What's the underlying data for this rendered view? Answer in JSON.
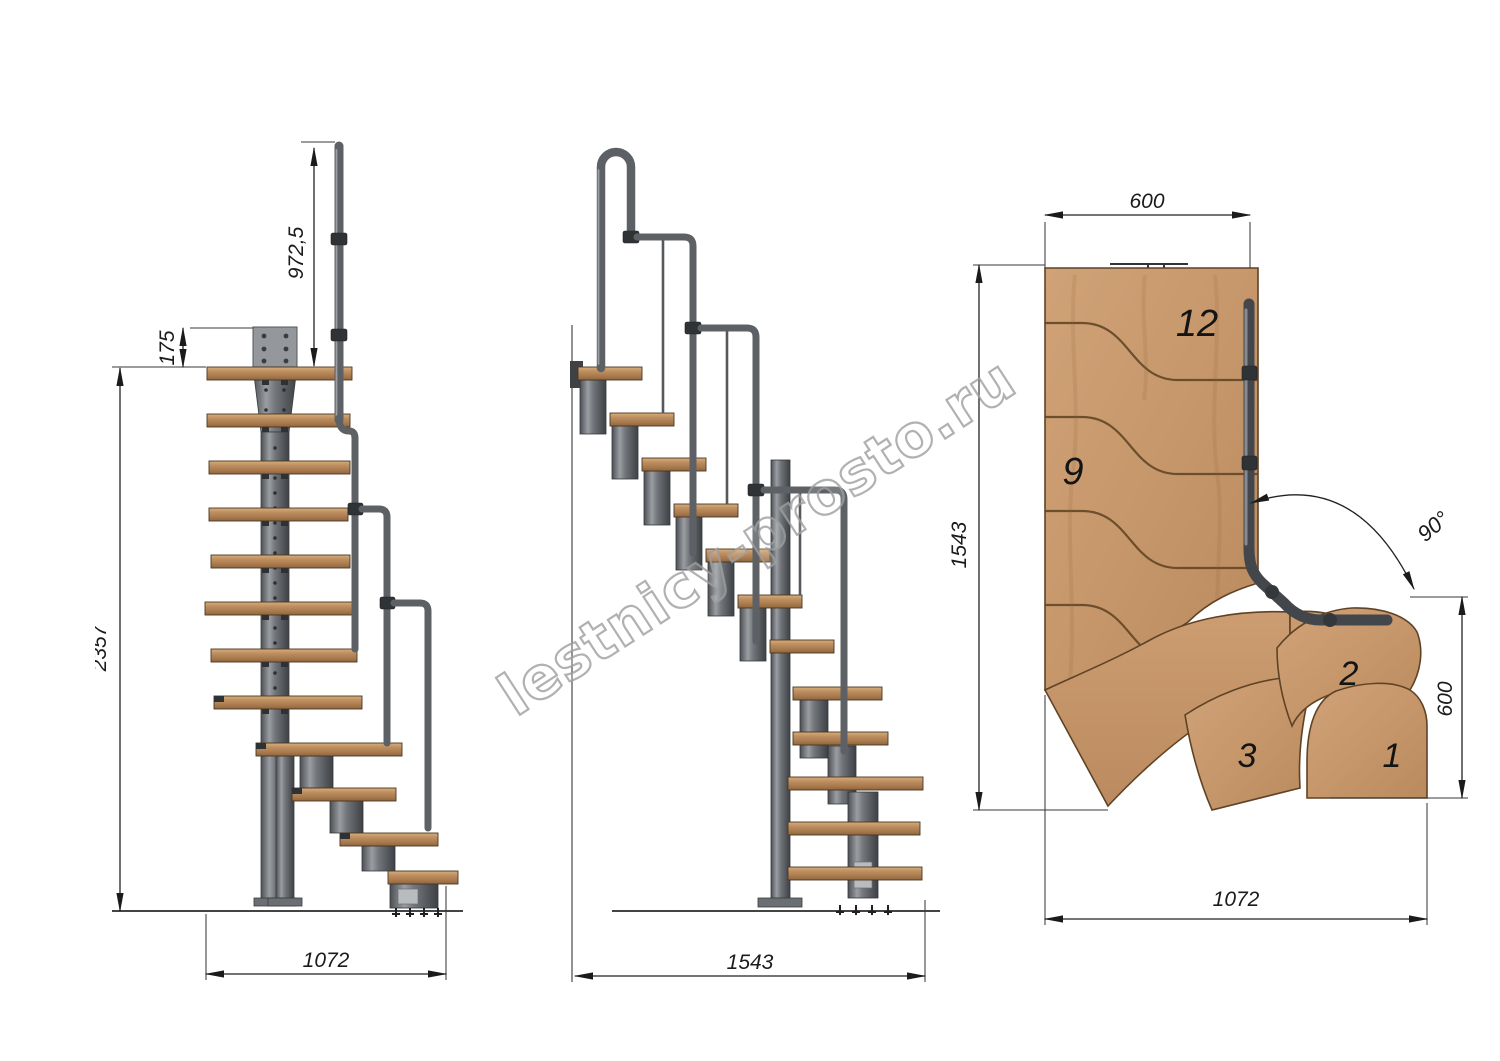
{
  "watermark": "lestnicy-prosto.ru",
  "side_view": {
    "dim_rail_height": "972,5",
    "dim_plate_offset": "175",
    "dim_total_height": "2357",
    "dim_run_length": "1072"
  },
  "front_view": {
    "dim_run_length": "1543"
  },
  "plan_view": {
    "dim_top_width": "600",
    "dim_left_depth": "1543",
    "dim_right_width": "600",
    "dim_bottom_run": "1072",
    "dim_turn_angle": "90°",
    "steps": [
      {
        "label": "12"
      },
      {
        "label": "9"
      },
      {
        "label": "2"
      },
      {
        "label": "3"
      },
      {
        "label": "1"
      }
    ]
  },
  "colors": {
    "wood_side": "#b98a5c",
    "wood_plan": "#c89a6e",
    "metal": "#6d7175",
    "metal_dark": "#3f4246",
    "line": "#222222",
    "watermark": "#9e9e9e"
  }
}
